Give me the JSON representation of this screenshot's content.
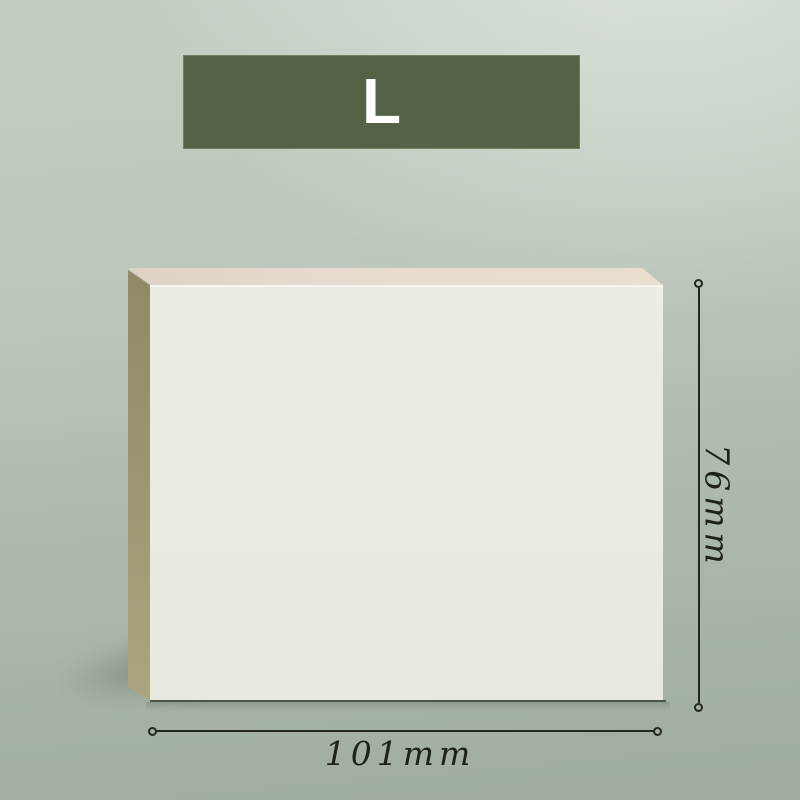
{
  "banner": {
    "label": "L",
    "bg_color": "#566246",
    "text_color": "#ffffff"
  },
  "pad": {
    "front_color": "#ebebe3",
    "top_color": "#e6dbce",
    "side_color": "#9b9571"
  },
  "dimensions": {
    "width_label": "101mm",
    "height_label": "76mm",
    "line_color": "#23281e",
    "text_color": "#1e231a"
  },
  "background": {
    "top_color": "#c9d3c9",
    "bottom_color": "#9fae9f"
  }
}
